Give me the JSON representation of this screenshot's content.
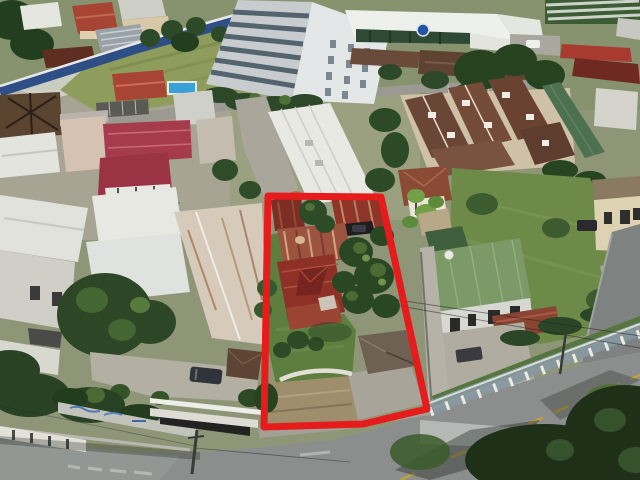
{
  "scene": {
    "type": "aerial-drone-photo",
    "subject": "residential-property-highlighted-with-red-boundary-outline",
    "property_outline": {
      "points": "268,196 381,197 427,409 363,424 264,427",
      "stroke_color": "#E61C1C",
      "stroke_width": "7"
    },
    "palette": {
      "asphalt": "#8B8E8C",
      "asphalt_dark": "#7E8280",
      "concrete": "#B3AFA3",
      "grass": "#5E7E40",
      "grass_olive": "#8E9C5C",
      "lawn_right": "#6E8A48",
      "tree_dark": "#294723",
      "roof_rust": "#8E3026",
      "roof_red_bright": "#A84434",
      "roof_crimson": "#A63B4C",
      "roof_green": "#7C9A68",
      "roof_brown": "#6A4636",
      "roof_maroon": "#6E2A20",
      "white_roof": "#EEF0EC",
      "blue_wall": "#2E4E86",
      "pool_blue": "#3AA0D8",
      "logo_blue": "#2255A8",
      "road_line_yellow": "#C4A23A",
      "dirt": "#9E8E6C"
    }
  }
}
